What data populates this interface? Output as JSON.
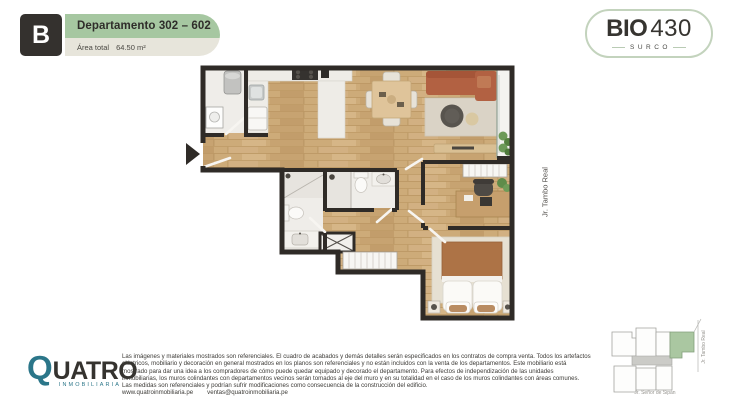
{
  "header": {
    "unit_letter": "B",
    "title": "Departamento 302 – 602",
    "area_label": "Área total",
    "area_value": "64.50 m²"
  },
  "brand": {
    "name_bold": "BIO",
    "name_light": "430",
    "district": "SURCO"
  },
  "plan": {
    "street_label": "Jr. Tambo Real"
  },
  "keyplan": {
    "street_right": "Jr. Tambo Real",
    "street_bottom": "Jr. Señor de Sipán"
  },
  "footer": {
    "logo": {
      "q": "Q",
      "rest": "UATRO",
      "sub": "INMOBILIARIA"
    },
    "disclaimer_lines": [
      "Las imágenes y materiales mostrados son referenciales. El cuadro de acabados y demás detalles serán especificados en los contratos de compra venta. Todos los artefactos",
      "eléctricos, mobiliario y decoración en general mostrados en los planos son referenciales y no están incluidos con la venta de los departamentos. Este mobiliario está",
      "mostrado para dar una idea a los compradores de cómo puede quedar equipado y decorado el departamento. Para efectos de independización de las unidades",
      "inmobiliarias, los muros colindantes con departamentos vecinos serán tomados al eje del muro y en su totalidad en el caso de los muros colindantes con áreas comunes.",
      "Las medidas son referenciales y podrían sufrir modificaciones como consecuencia de la construcción del edificio."
    ],
    "website": "www.quatroinmobiliaria.pe",
    "email": "ventas@quatroinmobiliaria.pe"
  },
  "colors": {
    "accent_green": "#a6c7a1",
    "header_gray": "#e7e5db",
    "badge_dark": "#34312e",
    "brand_teal": "#2b7689",
    "wall_dark": "#2f2b27",
    "wood_floor": "#cdab79",
    "keyplan_unit_green": "#aac7a1"
  }
}
